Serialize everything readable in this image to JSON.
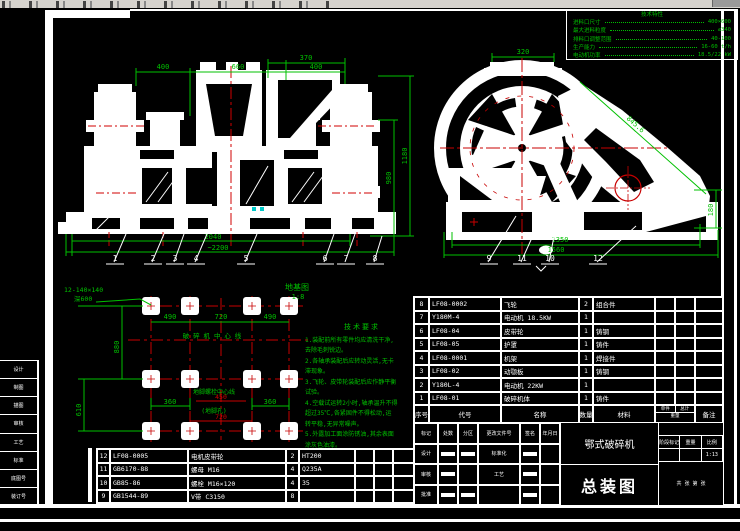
{
  "colors": {
    "green": "#00c000",
    "red": "#c80000",
    "white": "#ffffff",
    "cyan": "#00c8c8",
    "toolbar": "#d6d3ce"
  },
  "spec_table": {
    "title": "技术特性",
    "rows": [
      {
        "label": "进料口尺寸",
        "value": "400×600"
      },
      {
        "label": "最大进料粒度",
        "value": "≤340"
      },
      {
        "label": "排料口调整范围",
        "value": "40-100"
      },
      {
        "label": "生产能力",
        "value": "16-60 t/h"
      },
      {
        "label": "电动机功率",
        "value": "18.5/22 kW"
      }
    ]
  },
  "front_view": {
    "dims": {
      "top_left": "400",
      "top_mid": "660",
      "top_right": "400",
      "sub_top": "370",
      "right_outer": "1180",
      "right_inner": "980",
      "bottom_inner": "2040",
      "bottom_outer": "~2200"
    },
    "balloons": [
      "1",
      "2",
      "3",
      "4",
      "5",
      "6",
      "7",
      "8"
    ]
  },
  "side_view": {
    "dims": {
      "top": "320",
      "diagonal": "845.6",
      "right": "180",
      "bottom_inner": "1350",
      "bottom_outer": "1560"
    },
    "balloons": [
      "9",
      "11",
      "10",
      "12"
    ]
  },
  "foundation": {
    "title": "地基图",
    "scale": "1:8",
    "bolt_callout_line1": "12-140×140",
    "bolt_callout_line2": "深600",
    "dim_top_left": "490",
    "dim_top_mid": "720",
    "dim_top_right": "490",
    "dim_left_upper": "880",
    "dim_left_lower": "610",
    "dim_bottom_left": "360",
    "dim_bottom_right": "360",
    "dim_red_top": "450",
    "dim_red_bottom": "720",
    "label_center": "破 碎 机 中 心 线",
    "label_anchor": "地脚螺栓中心线",
    "label_hole": "(地脚孔)"
  },
  "notes": {
    "title": "技术要求",
    "lines": [
      "1.装配前所有零件均应清洗干净,",
      "去除毛刺锐边。",
      "2.各轴承装配后应转动灵活,无卡",
      "滞现象。",
      "3.飞轮、皮带轮装配后应作静平衡",
      "试验。",
      "4.空载试运转2小时,轴承温升不得",
      "超过35℃,各紧固件不得松动,运",
      "转平稳,无异常噪声。",
      "5.外露加工面涂防锈油,其余表面",
      "涂灰色油漆。"
    ]
  },
  "bom_right": {
    "header": [
      "序号",
      "代号",
      "名称",
      "数量",
      "材料",
      "单件",
      "总计",
      "备注"
    ],
    "weight_label": "重量",
    "rows": [
      {
        "no": "8",
        "code": "LF08-0002",
        "name": "飞轮",
        "qty": "2",
        "mat": "组合件"
      },
      {
        "no": "7",
        "code": "Y180M-4",
        "name": "电动机 18.5KW",
        "qty": "1",
        "mat": ""
      },
      {
        "no": "6",
        "code": "LF08-04",
        "name": "皮带轮",
        "qty": "1",
        "mat": "铸钢"
      },
      {
        "no": "5",
        "code": "LF08-05",
        "name": "护罩",
        "qty": "1",
        "mat": "铸件"
      },
      {
        "no": "4",
        "code": "LF08-0001",
        "name": "机架",
        "qty": "1",
        "mat": "焊接件"
      },
      {
        "no": "3",
        "code": "LF08-02",
        "name": "动颚板",
        "qty": "1",
        "mat": "铸钢"
      },
      {
        "no": "2",
        "code": "Y180L-4",
        "name": "电动机 22KW",
        "qty": "1",
        "mat": ""
      },
      {
        "no": "1",
        "code": "LF08-01",
        "name": "破碎机体",
        "qty": "1",
        "mat": "铸件"
      }
    ]
  },
  "bom_left": {
    "rows": [
      {
        "no": "12",
        "code": "LF08-0005",
        "name": "电机皮带轮",
        "qty": "2",
        "mat": "HT200"
      },
      {
        "no": "11",
        "code": "GB6170-88",
        "name": "螺母 M16",
        "qty": "4",
        "mat": "Q235A"
      },
      {
        "no": "10",
        "code": "GB85-86",
        "name": "螺栓 M16×120",
        "qty": "4",
        "mat": "35"
      },
      {
        "no": "9",
        "code": "GB1544-89",
        "name": "V带 C3150",
        "qty": "8",
        "mat": ""
      }
    ]
  },
  "title_block": {
    "product": "鄂式破碎机",
    "drawing_type": "总装图",
    "scale": "1:13",
    "labels": {
      "mark": "标记",
      "count": "处数",
      "zone": "分区",
      "doc_no": "更改文件号",
      "sign": "签名",
      "date": "年月日",
      "design": "设计",
      "standard": "标准化",
      "check": "审核",
      "process": "工艺",
      "approve": "批准",
      "stage": "阶段标记",
      "weight": "重量",
      "scale_label": "比例",
      "sheet": "共 张 第 张"
    }
  },
  "margin_strip": {
    "rows": [
      "设计",
      "制图",
      "描图",
      "审核",
      "工艺",
      "标准",
      "底图号",
      "装订号"
    ]
  }
}
